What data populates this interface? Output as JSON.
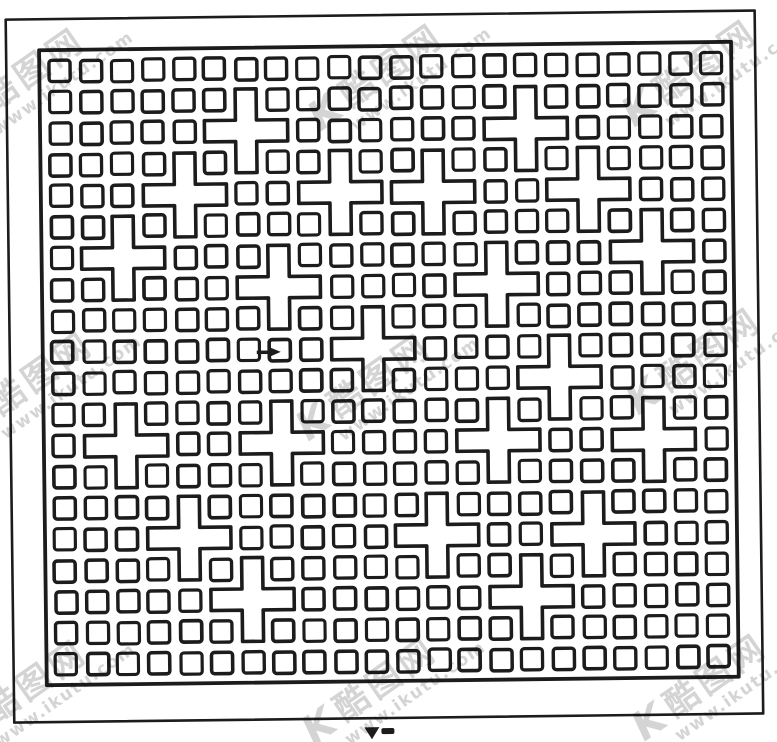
{
  "canvas": {
    "width": 777,
    "height": 742,
    "background": "#ffffff",
    "ink": "#1c1c1c",
    "tilt_deg": -0.7
  },
  "frames": {
    "outer": {
      "x": 10,
      "y": 15,
      "w": 749,
      "h": 703,
      "stroke": 2.6
    },
    "inner": {
      "x": 43,
      "y": 46,
      "w": 692,
      "h": 635,
      "stroke": 3.8
    }
  },
  "pattern": {
    "description": "lattice of small outlined squares with plus-cross motifs",
    "cols": 22,
    "rows": 20,
    "origin_x": 47.5,
    "origin_y": 51.5,
    "pitch_x": 31.05,
    "pitch_y": 31.25,
    "inset": 5,
    "corner_radius": 3,
    "stroke": 3.4,
    "cross_cells": [
      [
        6,
        2
      ],
      [
        15,
        2
      ],
      [
        4,
        4
      ],
      [
        9,
        4
      ],
      [
        12,
        4
      ],
      [
        17,
        4
      ],
      [
        2,
        6
      ],
      [
        19,
        6
      ],
      [
        7,
        7
      ],
      [
        14,
        7
      ],
      [
        10,
        9
      ],
      [
        16,
        10
      ],
      [
        2,
        12
      ],
      [
        7,
        12
      ],
      [
        14,
        12
      ],
      [
        19,
        12
      ],
      [
        4,
        15
      ],
      [
        12,
        15
      ],
      [
        17,
        15
      ],
      [
        6,
        17
      ],
      [
        15,
        17
      ]
    ]
  },
  "artifacts": {
    "cursor_mark": {
      "x": 257,
      "y": 345
    },
    "caption_fragments": [
      {
        "type": "triangle",
        "x": 360,
        "y": 727,
        "w": 15,
        "h": 12
      },
      {
        "type": "bar",
        "x": 377,
        "y": 728,
        "w": 13,
        "h": 6
      }
    ]
  },
  "watermark": {
    "logo": "K",
    "brand": "酷图网",
    "url": "www.ikutu.com",
    "color": "#b5b5b5",
    "instances": [
      {
        "x": 40,
        "y": 76
      },
      {
        "x": 398,
        "y": 72
      },
      {
        "x": 712,
        "y": 68
      },
      {
        "x": 48,
        "y": 380
      },
      {
        "x": 386,
        "y": 382
      },
      {
        "x": 716,
        "y": 356
      },
      {
        "x": 42,
        "y": 688
      },
      {
        "x": 392,
        "y": 686
      },
      {
        "x": 722,
        "y": 682
      }
    ]
  }
}
